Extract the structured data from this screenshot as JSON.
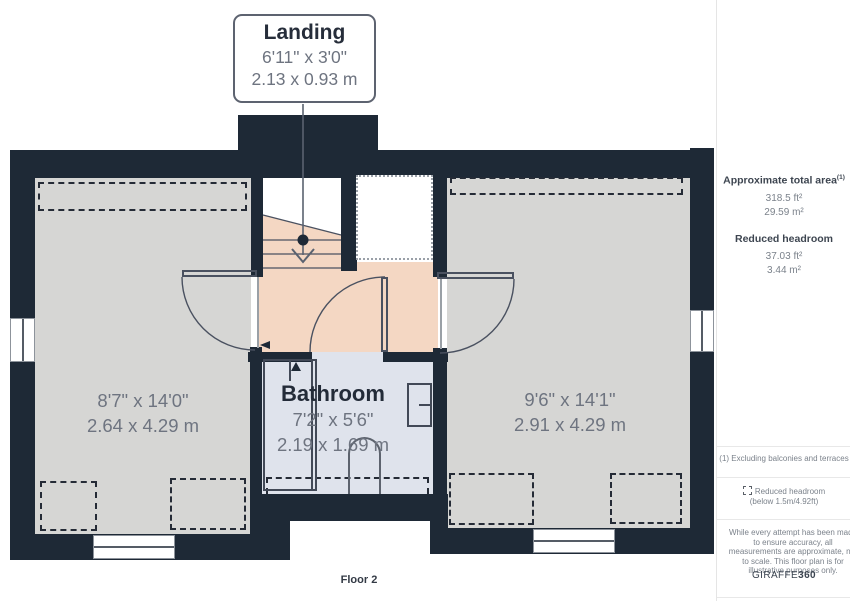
{
  "plan": {
    "floor_label": "Floor 2",
    "callout": {
      "title": "Landing",
      "imperial": "6'11\" x 3'0\"",
      "metric": "2.13 x 0.93 m"
    },
    "rooms": {
      "left": {
        "imperial": "8'7\" x 14'0\"",
        "metric": "2.64 x 4.29 m"
      },
      "right": {
        "imperial": "9'6\" x 14'1\"",
        "metric": "2.91 x 4.29 m"
      },
      "bathroom": {
        "name": "Bathroom",
        "imperial": "7'2\" x 5'6\"",
        "metric": "2.19 x 1.69 m"
      }
    },
    "colors": {
      "wall": "#1e2936",
      "room_floor": "#d6d6d4",
      "landing_floor": "#f4d7c3",
      "bathroom_floor": "#dfe3ec"
    }
  },
  "sidebar": {
    "total_area": {
      "label": "Approximate total area",
      "footnote_marker": "(1)",
      "imperial": "318.5 ft²",
      "metric": "29.59 m²"
    },
    "reduced_headroom": {
      "label": "Reduced headroom",
      "imperial": "37.03 ft²",
      "metric": "3.44 m²"
    },
    "footnote": "(1) Excluding balconies and terraces",
    "legend": {
      "label": "Reduced headroom",
      "sublabel": "(below 1.5m/4.92ft)"
    },
    "disclaimer": "While every attempt has been made to ensure accuracy, all measurements are approximate, not to scale. This floor plan is for illustrative purposes only.",
    "brand": {
      "name": "GIRAFFE",
      "suffix": "360"
    }
  }
}
